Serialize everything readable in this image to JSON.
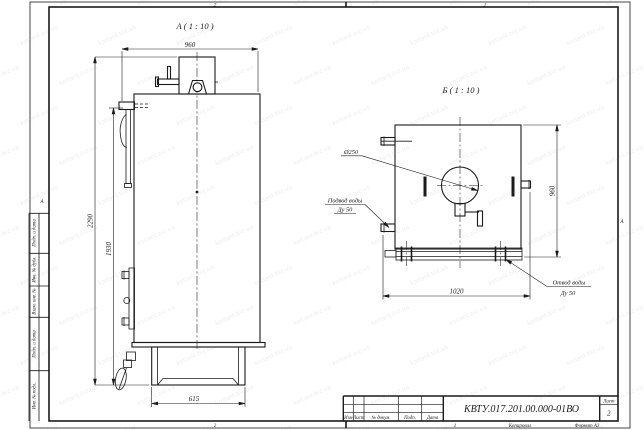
{
  "frame": {
    "zone_top_left": "2",
    "zone_top_right": "1",
    "zone_bottom_left": "2",
    "zone_bottom_right": "1",
    "fold_mark_left": "А",
    "fold_mark_right": "А",
    "kopiroval": "Копировал",
    "format": "Формат А3"
  },
  "stamp": {
    "doc_number": "КВТУ.017.201.00.000-01ВО",
    "sheet_label": "Лист",
    "sheet_number": "2",
    "col_izm": "Изм",
    "col_list": "Лист",
    "col_dokum": "№ докум.",
    "col_podp": "Подп.",
    "col_data": "Дата"
  },
  "margin_cells": {
    "c1": "Подп. и дата",
    "c2": "Инв. № дубл.",
    "c3": "Взам. инв. №",
    "c4": "Подп. и дата",
    "c5": "Инв. № подл."
  },
  "view_a": {
    "title": "А ( 1 : 10 )",
    "dim_width": "960",
    "dim_height_total": "2290",
    "dim_height_door": "1930",
    "dim_base": "615"
  },
  "view_b": {
    "title": "Б ( 1 : 10 )",
    "dim_height": "960",
    "dim_width": "1020",
    "label_diameter": "Ø250",
    "inlet_1": "Подвод воды",
    "inlet_2": "Ду 50",
    "outlet_1": "Отвод воды",
    "outlet_2": "Ду 50"
  },
  "watermark": {
    "text": "kotlant.biz.ua"
  }
}
